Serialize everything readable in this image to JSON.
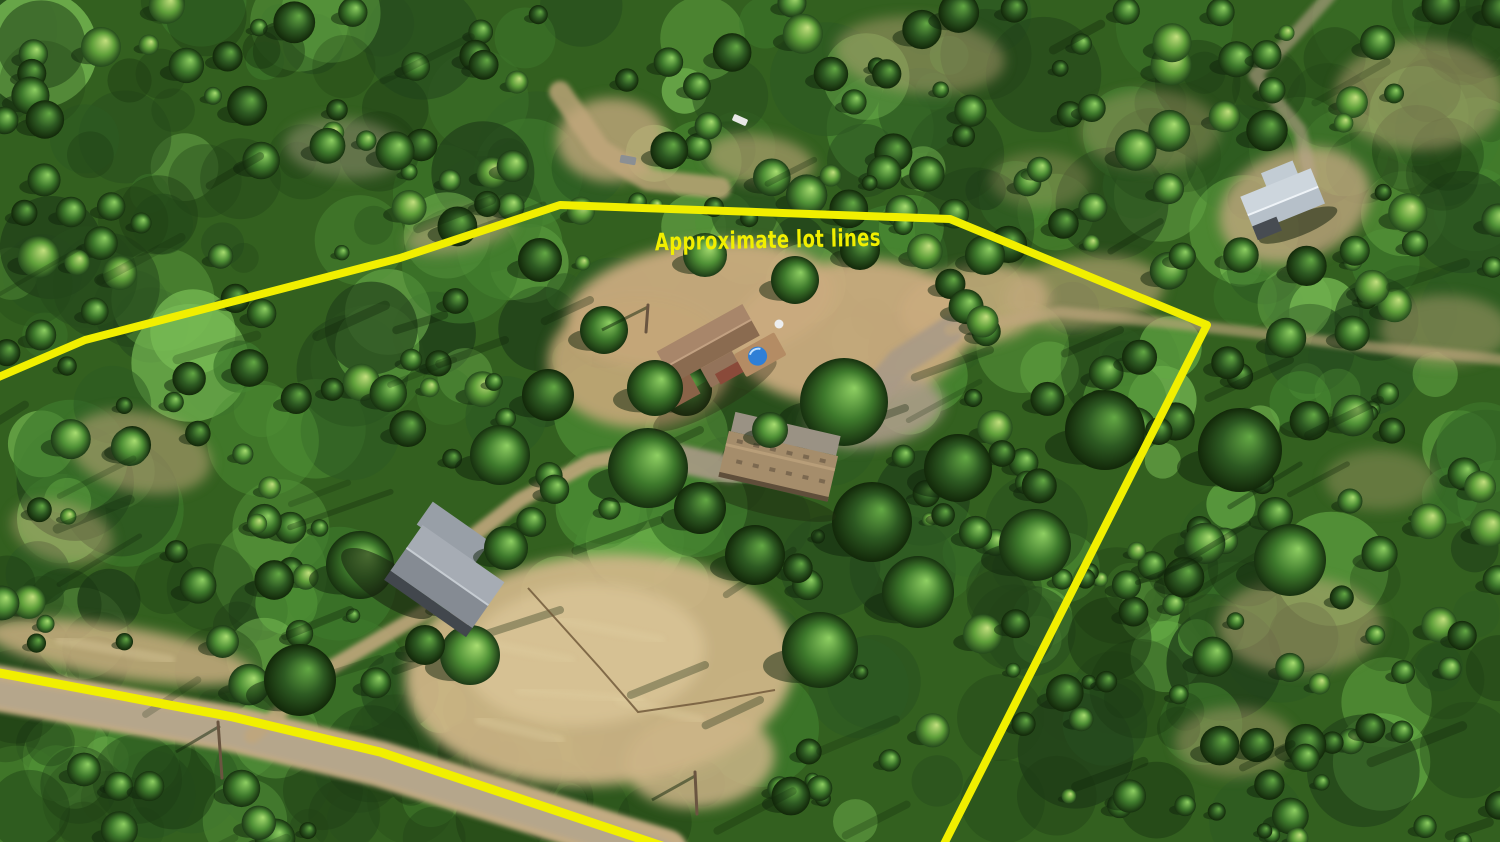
{
  "annotation": {
    "label": "Approximate lot lines",
    "color": "#f1ef00",
    "x": 655,
    "y": 248,
    "font_size": 24,
    "text_length": 226,
    "rotation": -1.2
  },
  "lot_line": {
    "color": "#f1ef00",
    "width": 8,
    "points": [
      [
        -6,
        379
      ],
      [
        85,
        340
      ],
      [
        400,
        258
      ],
      [
        560,
        205
      ],
      [
        950,
        219
      ],
      [
        1207,
        325
      ],
      [
        942,
        848
      ]
    ]
  },
  "road_line": {
    "color": "#f1ef00",
    "width": 9,
    "points": [
      [
        -6,
        672
      ],
      [
        233,
        717
      ],
      [
        380,
        752
      ],
      [
        668,
        848
      ]
    ]
  },
  "palette": {
    "base": "#33601f",
    "canopy": [
      "#2d5a22",
      "#3e7a2c",
      "#4f9136",
      "#63a844",
      "#79bd55",
      "#274d1e",
      "#203f19"
    ],
    "dark_canopy": [
      "#1c3a14",
      "#224418",
      "#16300f"
    ],
    "dirt": "#c9ab7e",
    "dirt_light": "#dbc697",
    "dirt_gray": "#a89a86",
    "shadow": "#10240b",
    "tree_gradients": {
      "bright": [
        "#a8dd70",
        "#4f9136",
        "#1d3a16"
      ],
      "mid": [
        "#8ecf62",
        "#3e7a2c",
        "#17310f"
      ],
      "deep": [
        "#63a844",
        "#2d5a22",
        "#122809"
      ],
      "yellow": [
        "#c3e07e",
        "#5fa03a",
        "#254a1c"
      ]
    }
  },
  "buildings": [
    {
      "name": "main-house",
      "kind": "house",
      "x": 713,
      "y": 350,
      "rotation": -29,
      "roof_light": "#a8866a",
      "roof_dark": "#8a6b50",
      "wing_color": "#8a6348",
      "wall_color": "#8a4a3a",
      "deck_color": "#b48c64",
      "hot_tub_color": "#2f7fd6"
    },
    {
      "name": "workshop-garage",
      "kind": "longroof",
      "x": 779,
      "y": 463,
      "rotation": 13,
      "roof_color": "#a58d6b",
      "ridge_color": "#b89e79",
      "vent_color": "#7c6950",
      "apron_color": "#9a9284"
    },
    {
      "name": "metal-barn",
      "kind": "gablebarn",
      "x": 452,
      "y": 570,
      "rotation": 35,
      "roof_light": "#a6acb4",
      "roof_dark": "#858b93",
      "wing_color": "#989fa7",
      "wall_color": "#42474d"
    },
    {
      "name": "neighbor-house",
      "kind": "gablehouse",
      "x": 1283,
      "y": 201,
      "rotation": -22,
      "roof_light": "#cdd6dd",
      "roof_dark": "#b6c0c9",
      "wing_color": "#c2ccd4",
      "wall_color": "#474c52"
    }
  ],
  "terrain": {
    "clearings": [
      {
        "cx": 700,
        "cy": 305,
        "rx": 135,
        "ry": 62,
        "rot": -8,
        "fill": "#c9ab7e",
        "op": 0.95
      },
      {
        "cx": 852,
        "cy": 332,
        "rx": 120,
        "ry": 72,
        "rot": -5,
        "fill": "#c9ab7e",
        "op": 0.95
      },
      {
        "cx": 640,
        "cy": 362,
        "rx": 92,
        "ry": 66,
        "rot": 0,
        "fill": "#c4a678",
        "op": 0.9
      },
      {
        "cx": 975,
        "cy": 305,
        "rx": 75,
        "ry": 40,
        "rot": -8,
        "fill": "#c9ab7e",
        "op": 0.85
      },
      {
        "cx": 1085,
        "cy": 292,
        "rx": 80,
        "ry": 36,
        "rot": -6,
        "fill": "#c2a87c",
        "op": 0.6
      },
      {
        "cx": 875,
        "cy": 412,
        "rx": 70,
        "ry": 34,
        "rot": -10,
        "fill": "#a89a86",
        "op": 0.9
      },
      {
        "cx": 600,
        "cy": 670,
        "rx": 195,
        "ry": 115,
        "rot": -4,
        "fill": "#cdb487",
        "op": 0.95
      },
      {
        "cx": 585,
        "cy": 655,
        "rx": 120,
        "ry": 70,
        "rot": -4,
        "fill": "#dbc697",
        "op": 0.8
      },
      {
        "cx": 700,
        "cy": 760,
        "rx": 75,
        "ry": 48,
        "rot": -6,
        "fill": "#cdb487",
        "op": 0.85
      },
      {
        "cx": 120,
        "cy": 652,
        "rx": 135,
        "ry": 26,
        "rot": 9,
        "fill": "#c9ae80",
        "op": 0.85
      },
      {
        "cx": 612,
        "cy": 140,
        "rx": 55,
        "ry": 42,
        "rot": 0,
        "fill": "#c2a87c",
        "op": 0.8
      },
      {
        "cx": 760,
        "cy": 160,
        "rx": 55,
        "ry": 25,
        "rot": 8,
        "fill": "#c2a87c",
        "op": 0.6
      },
      {
        "cx": 920,
        "cy": 55,
        "rx": 85,
        "ry": 38,
        "rot": 5,
        "fill": "#c2a87c",
        "op": 0.45
      },
      {
        "cx": 1295,
        "cy": 205,
        "rx": 78,
        "ry": 55,
        "rot": -20,
        "fill": "#c0a87e",
        "op": 0.8
      },
      {
        "cx": 1420,
        "cy": 95,
        "rx": 85,
        "ry": 55,
        "rot": 0,
        "fill": "#c2a87c",
        "op": 0.5
      },
      {
        "cx": 1445,
        "cy": 330,
        "rx": 65,
        "ry": 35,
        "rot": 0,
        "fill": "#c2a87c",
        "op": 0.45
      },
      {
        "cx": 1380,
        "cy": 480,
        "rx": 55,
        "ry": 30,
        "rot": 0,
        "fill": "#c2a87c",
        "op": 0.35
      },
      {
        "cx": 1300,
        "cy": 625,
        "rx": 82,
        "ry": 48,
        "rot": 0,
        "fill": "#c2a87c",
        "op": 0.5
      },
      {
        "cx": 1235,
        "cy": 742,
        "rx": 60,
        "ry": 35,
        "rot": 0,
        "fill": "#c2a87c",
        "op": 0.4
      },
      {
        "cx": 140,
        "cy": 452,
        "rx": 72,
        "ry": 40,
        "rot": 12,
        "fill": "#c2a87c",
        "op": 0.55
      },
      {
        "cx": 62,
        "cy": 532,
        "rx": 52,
        "ry": 30,
        "rot": 15,
        "fill": "#c2a87c",
        "op": 0.45
      },
      {
        "cx": 345,
        "cy": 148,
        "rx": 60,
        "ry": 30,
        "rot": 5,
        "fill": "#b9ab90",
        "op": 0.4
      },
      {
        "cx": 460,
        "cy": 232,
        "rx": 55,
        "ry": 20,
        "rot": -12,
        "fill": "#b9a179",
        "op": 0.6
      },
      {
        "cx": 1150,
        "cy": 130,
        "rx": 70,
        "ry": 40,
        "rot": 0,
        "fill": "#c2a87c",
        "op": 0.35
      },
      {
        "cx": 1040,
        "cy": 180,
        "rx": 50,
        "ry": 28,
        "rot": 0,
        "fill": "#c2a87c",
        "op": 0.3
      }
    ],
    "roads": [
      {
        "name": "main-road",
        "points": [
          [
            -10,
            687
          ],
          [
            233,
            729
          ],
          [
            380,
            764
          ],
          [
            665,
            852
          ]
        ],
        "width": 46,
        "color": "#c3ab82",
        "op": 1
      },
      {
        "name": "main-road-center",
        "points": [
          [
            -10,
            692
          ],
          [
            233,
            734
          ],
          [
            380,
            769
          ],
          [
            660,
            852
          ]
        ],
        "width": 26,
        "color": "#b3a48d",
        "op": 0.85
      },
      {
        "name": "driveway",
        "points": [
          [
            252,
            736
          ],
          [
            330,
            668
          ],
          [
            425,
            612
          ],
          [
            462,
            584
          ],
          [
            468,
            540
          ],
          [
            520,
            500
          ],
          [
            590,
            462
          ],
          [
            650,
            450
          ]
        ],
        "width": 15,
        "color": "#bfa67c",
        "op": 0.9
      },
      {
        "name": "house-loop",
        "points": [
          [
            650,
            452
          ],
          [
            730,
            470
          ],
          [
            800,
            452
          ],
          [
            855,
            415
          ],
          [
            900,
            362
          ],
          [
            950,
            330
          ]
        ],
        "width": 28,
        "color": "#a89a86",
        "op": 0.9
      },
      {
        "name": "ne-trail",
        "points": [
          [
            950,
            330
          ],
          [
            1060,
            312
          ],
          [
            1160,
            322
          ],
          [
            1250,
            332
          ],
          [
            1380,
            348
          ],
          [
            1505,
            360
          ]
        ],
        "width": 11,
        "color": "#bfa67c",
        "op": 0.65
      },
      {
        "name": "top-road",
        "points": [
          [
            560,
            92
          ],
          [
            600,
            150
          ],
          [
            648,
            180
          ],
          [
            720,
            188
          ]
        ],
        "width": 22,
        "color": "#c2a87c",
        "op": 0.8
      },
      {
        "name": "neighbor-driveway",
        "points": [
          [
            1330,
            -5
          ],
          [
            1290,
            40
          ],
          [
            1255,
            75
          ],
          [
            1300,
            130
          ],
          [
            1310,
            175
          ]
        ],
        "width": 13,
        "color": "#b8a48a",
        "op": 0.6
      }
    ],
    "exclusions": [
      {
        "cx": 770,
        "cy": 355,
        "rx": 205,
        "ry": 130
      },
      {
        "cx": 612,
        "cy": 675,
        "rx": 195,
        "ry": 120
      },
      {
        "cx": 700,
        "cy": 762,
        "rx": 80,
        "ry": 50
      },
      {
        "cx": 1290,
        "cy": 203,
        "rx": 72,
        "ry": 55
      },
      {
        "cx": 612,
        "cy": 140,
        "rx": 55,
        "ry": 45
      },
      {
        "cx": 1075,
        "cy": 295,
        "rx": 85,
        "ry": 42
      }
    ],
    "road_corridor": {
      "points": [
        [
          0,
          690
        ],
        [
          233,
          733
        ],
        [
          380,
          768
        ],
        [
          662,
          850
        ]
      ],
      "radius": 42
    },
    "shadow_streaks": [
      [
        905,
        408,
        110,
        200
      ],
      [
        840,
        430,
        70,
        205
      ],
      [
        700,
        430,
        60,
        205
      ],
      [
        660,
        520,
        90,
        200
      ],
      [
        560,
        610,
        110,
        198
      ],
      [
        705,
        665,
        80,
        202
      ],
      [
        760,
        700,
        60,
        205
      ],
      [
        505,
        340,
        70,
        200
      ],
      [
        590,
        300,
        50,
        205
      ],
      [
        990,
        350,
        80,
        200
      ],
      [
        1120,
        330,
        60,
        203
      ],
      [
        1290,
        360,
        90,
        205
      ],
      [
        1380,
        400,
        80,
        206
      ],
      [
        480,
        640,
        90,
        200
      ],
      [
        350,
        610,
        70,
        202
      ]
    ],
    "grass_streaks": [
      [
        470,
        640,
        570,
        660
      ],
      [
        520,
        690,
        640,
        700
      ],
      [
        560,
        620,
        660,
        640
      ],
      [
        620,
        700,
        700,
        720
      ],
      [
        480,
        720,
        560,
        740
      ],
      [
        60,
        640,
        170,
        660
      ]
    ]
  },
  "feature_trees": [
    [
      648,
      468,
      40,
      "mid"
    ],
    [
      686,
      390,
      26,
      "deep"
    ],
    [
      844,
      402,
      44,
      "mid"
    ],
    [
      872,
      522,
      40,
      "deep"
    ],
    [
      918,
      592,
      36,
      "mid"
    ],
    [
      958,
      468,
      34,
      "deep"
    ],
    [
      604,
      330,
      24,
      "mid"
    ],
    [
      548,
      395,
      26,
      "deep"
    ],
    [
      500,
      455,
      30,
      "mid"
    ],
    [
      755,
      555,
      30,
      "deep"
    ],
    [
      820,
      650,
      38,
      "mid"
    ],
    [
      470,
      655,
      30,
      "bright"
    ],
    [
      360,
      565,
      34,
      "mid"
    ],
    [
      300,
      680,
      36,
      "deep"
    ],
    [
      1105,
      430,
      40,
      "deep"
    ],
    [
      1035,
      545,
      36,
      "mid"
    ],
    [
      1240,
      450,
      42,
      "deep"
    ],
    [
      1290,
      560,
      36,
      "mid"
    ],
    [
      705,
      255,
      22,
      "bright"
    ],
    [
      795,
      280,
      24,
      "mid"
    ],
    [
      860,
      250,
      20,
      "deep"
    ],
    [
      985,
      255,
      20,
      "mid"
    ],
    [
      540,
      260,
      22,
      "deep"
    ]
  ],
  "foreground_trees": [
    [
      655,
      388,
      28,
      "mid"
    ],
    [
      700,
      508,
      26,
      "deep"
    ],
    [
      506,
      548,
      22,
      "mid"
    ],
    [
      425,
      645,
      20,
      "deep"
    ],
    [
      770,
      430,
      18,
      "bright"
    ]
  ],
  "objects": {
    "fence": {
      "points": [
        [
          528,
          588
        ],
        [
          600,
          668
        ],
        [
          638,
          712
        ],
        [
          700,
          703
        ],
        [
          775,
          690
        ]
      ],
      "color": "#6b5436"
    },
    "poles": [
      {
        "line": [
          648,
          305,
          646,
          332
        ],
        "shadow": [
          648,
          307,
          602,
          330
        ]
      },
      {
        "line": [
          695,
          772,
          697,
          814
        ],
        "shadow": [
          695,
          776,
          652,
          800
        ]
      },
      {
        "line": [
          218,
          722,
          222,
          778
        ],
        "shadow": [
          220,
          726,
          176,
          752
        ]
      }
    ],
    "vehicles": [
      {
        "x": 740,
        "y": 120,
        "w": 15,
        "h": 7,
        "rot": 24,
        "color": "#e8e8e6"
      },
      {
        "x": 628,
        "y": 160,
        "w": 16,
        "h": 8,
        "rot": 10,
        "color": "#8b8f93"
      }
    ],
    "satellite_dish": {
      "x": 779,
      "y": 324,
      "r": 4.5,
      "color": "#eceef0"
    }
  }
}
